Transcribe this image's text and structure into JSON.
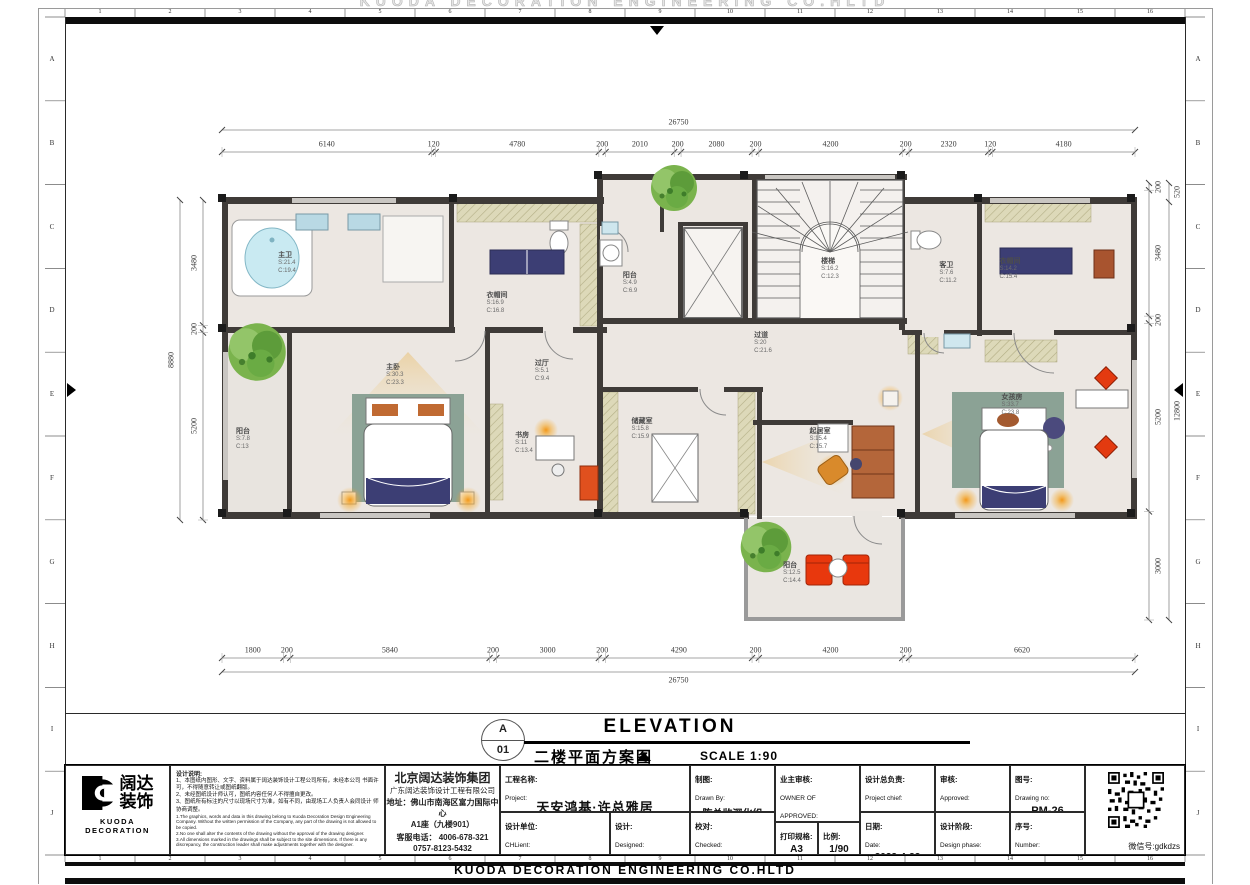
{
  "sheet": {
    "ghost_text": "KUODA DECORATION ENGINEERING CO.HLTD",
    "footer_text": "KUODA DECORATION ENGINEERING  CO.HLTD",
    "grid_numbers": [
      "1",
      "2",
      "3",
      "4",
      "5",
      "6",
      "7",
      "8",
      "9",
      "10",
      "11",
      "12",
      "13",
      "14",
      "15",
      "16"
    ],
    "grid_letters": [
      "A",
      "B",
      "C",
      "D",
      "E",
      "F",
      "G",
      "H",
      "I",
      "J"
    ]
  },
  "title": {
    "letter": "A",
    "number": "01",
    "en": "ELEVATION",
    "cn": "二楼平面方案图",
    "scale": "SCALE 1:90"
  },
  "dims": {
    "top_total": "26750",
    "top": [
      6140,
      120,
      4780,
      200,
      2010,
      200,
      2080,
      200,
      4200,
      200,
      2320,
      120,
      4180
    ],
    "bottom": [
      1800,
      200,
      5840,
      200,
      3000,
      200,
      4290,
      200,
      4200,
      200,
      6620
    ],
    "bottom_total": "26750",
    "left": [
      3480,
      200,
      5200
    ],
    "left_total": "8880",
    "right": [
      200,
      3480,
      200,
      5200,
      3000
    ],
    "right_outer_top": "520",
    "right_outer_total": "12800"
  },
  "rooms": [
    {
      "name": "主卫",
      "s": "S:21.4",
      "c": "C:19.4"
    },
    {
      "name": "衣帽间",
      "s": "S:16.9",
      "c": "C:16.8"
    },
    {
      "name": "阳台",
      "s": "S:4.9",
      "c": "C:6.9"
    },
    {
      "name": "楼梯",
      "s": "S:16.2",
      "c": "C:12.3"
    },
    {
      "name": "客卫",
      "s": "S:7.6",
      "c": "C:11.2"
    },
    {
      "name": "衣帽间",
      "s": "S:14.2",
      "c": "C:15.4"
    },
    {
      "name": "过道",
      "s": "S:20",
      "c": "C:21.6"
    },
    {
      "name": "过厅",
      "s": "S:5.1",
      "c": "C:9.4"
    },
    {
      "name": "主卧",
      "s": "S:30.3",
      "c": "C:23.3"
    },
    {
      "name": "书房",
      "s": "S:11",
      "c": "C:13.4"
    },
    {
      "name": "储藏室",
      "s": "S:15.8",
      "c": "C:15.9"
    },
    {
      "name": "起居室",
      "s": "S:15.4",
      "c": "C:15.7"
    },
    {
      "name": "女孩房",
      "s": "S:33.7",
      "c": "C:23.8"
    },
    {
      "name": "阳台",
      "s": "S:7.8",
      "c": "C:13"
    },
    {
      "name": "阳台",
      "s": "S:12.5",
      "c": "C:14.4"
    }
  ],
  "tb": {
    "logo_line1": "阔达",
    "logo_line2": "装饰",
    "logo_en": "KUODA  DECORATION",
    "notes_title": "设计说明:",
    "n1": "1、本图纸内图形、文字、资料属于阔达装饰设计工程公司所有，未经本公司 书面许可，不得随意转让或图纸翻版。",
    "n2": "2、未经图纸设计师认可，图纸内容任何人不得擅自更改。",
    "n3": "3、图纸所有标注的尺寸以现场尺寸为准，如有不同，由现场工人负责人会同设计 师协商调整。",
    "e1": "1.The graphics, words and data in this drawing belong to Kuoda Decoration Design Engineering Company. Without the written permission of the Company, any part of the drawing is not allowed to be copied.",
    "e2": "2.No one shall alter the contents of the drawing without the approval of the drawing designer.",
    "e3": "3.All dimensions marked in the drawings shall be subject to the site dimensions. If there is any discrepancy, the construction leader shall make adjustments together with the designer.",
    "co": [
      "北京阔达装饰集团",
      "广东阔达装饰设计工程有限公司",
      "地址：佛山市南海区富力国际中心",
      "A1座（九楼901）",
      "客服电话： 4006-678-321",
      "0757-8123-5432"
    ],
    "project_cn": "工程名称:",
    "project_en": "Project:",
    "project_val": "天安鸿基·许总雅居",
    "unit_cn": "设计单位:",
    "unit_en": "CHLient:",
    "unit_val": "北京阔达·巢艺设计院",
    "design_cn": "设计:",
    "design_en": "Designed:",
    "design_val": "陈总监设计组",
    "drawn_cn": "制图:",
    "drawn_en": "Drawn By:",
    "drawn_val": "陈总监深化组",
    "check_cn": "校对:",
    "check_en": "Checked:",
    "check_val": "陈总监设计组",
    "owner_cn": "业主审核:",
    "owner_en": "OWNER OF APPROVED:",
    "print_cn": "打印规格:",
    "print_val": "A3",
    "ratio_cn": "比例:",
    "ratio_val": "1/90",
    "chief_cn": "设计总负责:",
    "chief_en": "Project chief:",
    "date_cn": "日期:",
    "date_en": "Date:",
    "date_val": "2022-4-22",
    "appr_cn": "审核:",
    "appr_en": "Approved:",
    "phase_cn": "设计阶段:",
    "phase_en": "Design phase:",
    "phase_val": "毛坯新房",
    "no_cn": "图号:",
    "no_en": "Drawing no:",
    "no_val": "PM-26",
    "num_cn": "序号:",
    "num_en": "Number:",
    "wechat": "微信号:gdkdzs"
  }
}
